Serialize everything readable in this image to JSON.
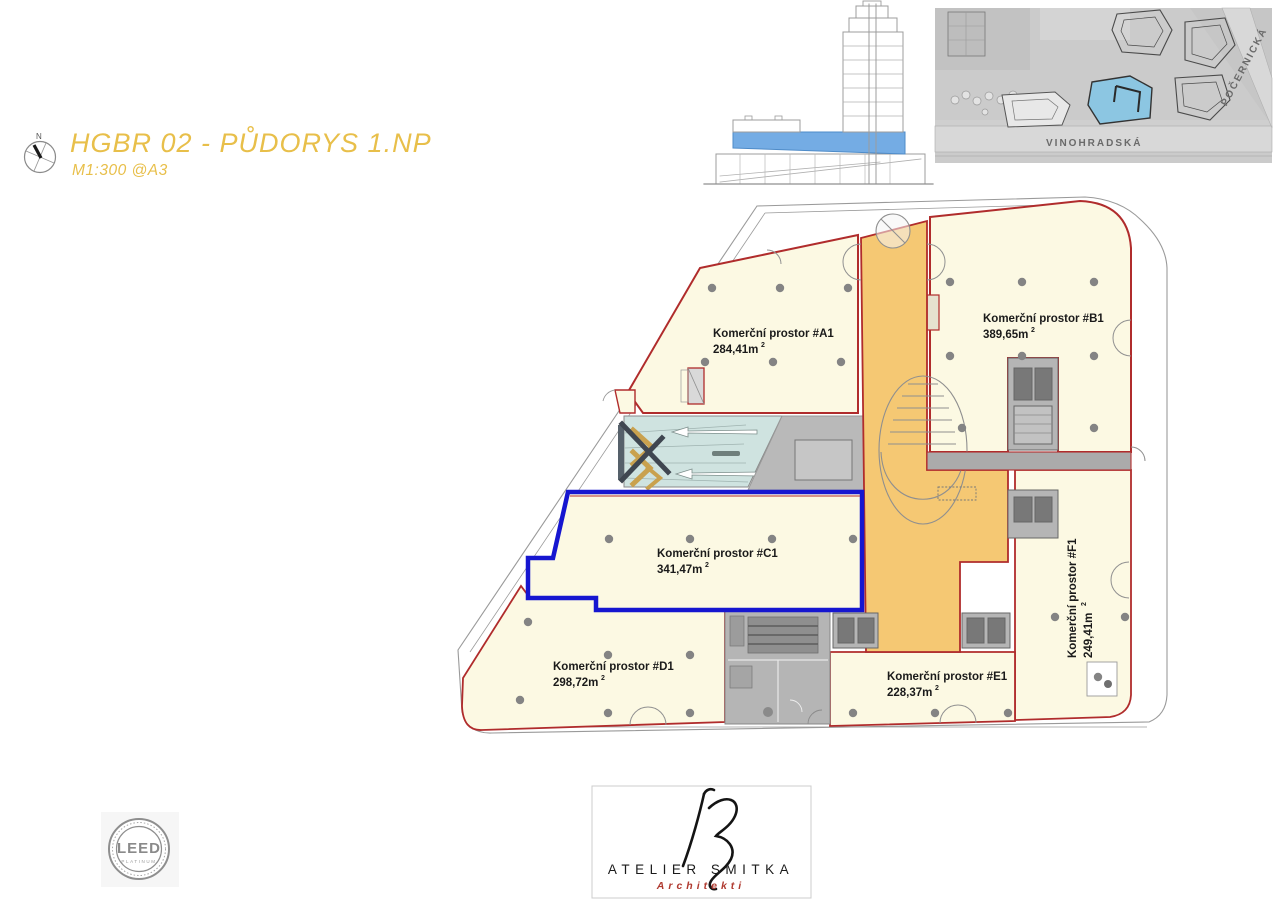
{
  "header": {
    "title": "HGBR 02 - PŮDORYS 1.NP",
    "scale": "M1:300 @A3",
    "north": "N"
  },
  "site_inset": {
    "street_horizontal": "VINOHRADSKÁ",
    "street_diagonal": "POČERNICKÁ"
  },
  "units": [
    {
      "id": "A1",
      "name": "Komerční prostor #A1",
      "area": "284,41m",
      "sup": "2"
    },
    {
      "id": "B1",
      "name": "Komerční prostor #B1",
      "area": "389,65m",
      "sup": "2"
    },
    {
      "id": "C1",
      "name": "Komerční prostor #C1",
      "area": "341,47m",
      "sup": "2"
    },
    {
      "id": "D1",
      "name": "Komerční prostor #D1",
      "area": "298,72m",
      "sup": "2"
    },
    {
      "id": "E1",
      "name": "Komerční prostor #E1",
      "area": "228,37m",
      "sup": "2"
    },
    {
      "id": "F1",
      "name": "Komerční prostor #F1",
      "area": "249,41m",
      "sup": "2"
    }
  ],
  "footer": {
    "leed_title": "LEED",
    "leed_level": "PLATINUM",
    "studio_name": "ATELIER SMITKA",
    "studio_subtitle": "Architekti"
  },
  "colors": {
    "accent_gold": "#E8BF4A",
    "unit_fill": "#FCF9E3",
    "core_fill": "#F5C873",
    "ramp_fill": "#CFE3E0",
    "outline_red": "#B02C2C",
    "highlight_blue": "#1616D0",
    "elevation_blue": "#74ACE4",
    "inset_building_blue": "#8CC6E2"
  }
}
